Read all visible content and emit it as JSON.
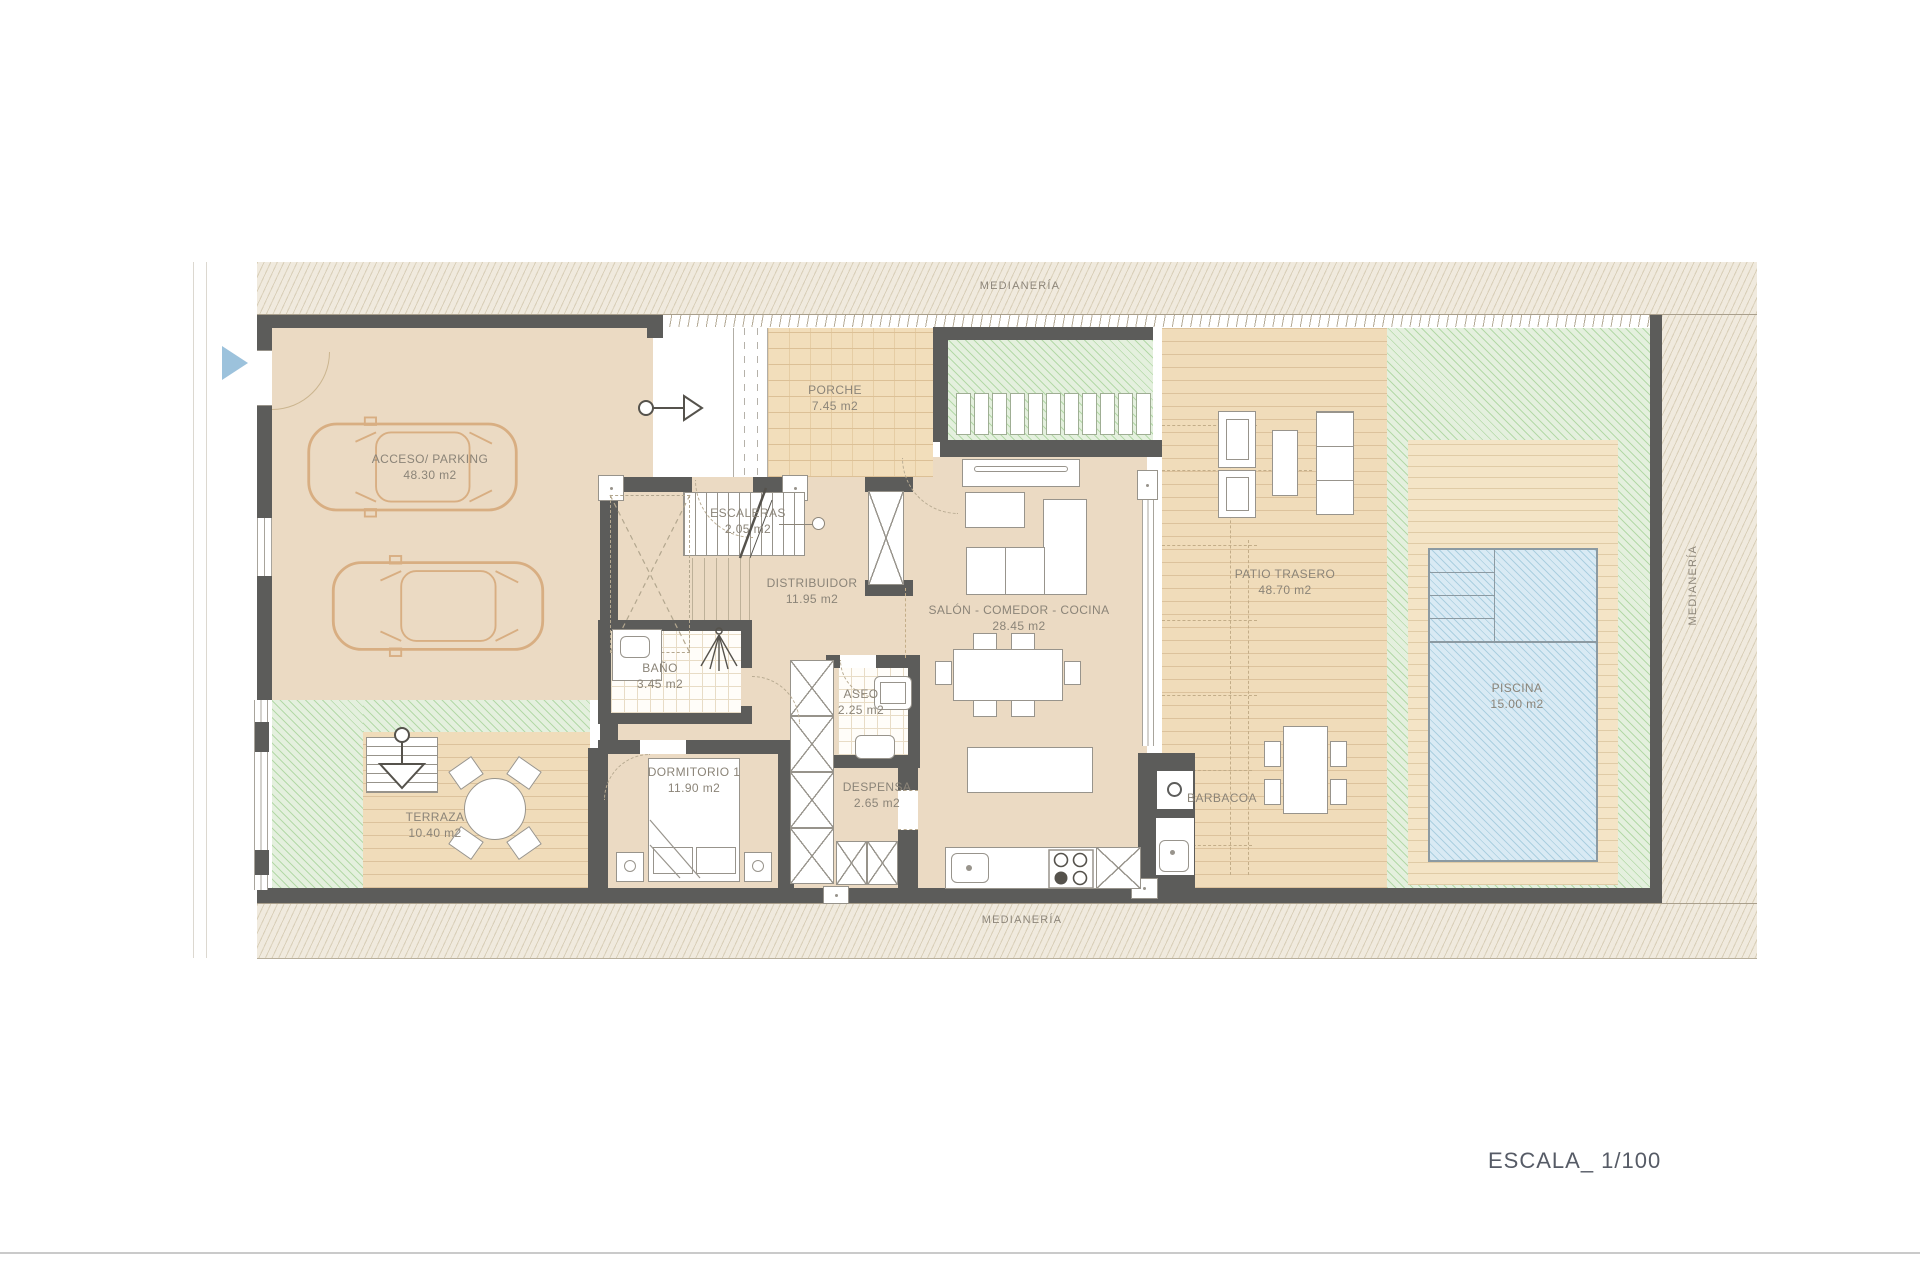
{
  "plan": {
    "scale_label": "ESCALA_ 1/100",
    "boundaries": {
      "top": "MEDIANERÍA",
      "bottom": "MEDIANERÍA",
      "right": "MEDIANERÍA"
    },
    "rooms": {
      "parking": {
        "name": "ACCESO/ PARKING",
        "area": "48.30 m2"
      },
      "porche": {
        "name": "PORCHE",
        "area": "7.45 m2"
      },
      "escaleras": {
        "name": "ESCALERAS",
        "area": "2.05 m2"
      },
      "distribuidor": {
        "name": "DISTRIBUIDOR",
        "area": "11.95 m2"
      },
      "salon": {
        "name": "SALÓN - COMEDOR - COCINA",
        "area": "28.45 m2"
      },
      "patio": {
        "name": "PATIO TRASERO",
        "area": "48.70 m2"
      },
      "bano": {
        "name": "BAÑO",
        "area": "3.45 m2"
      },
      "aseo": {
        "name": "ASEO",
        "area": "2.25 m2"
      },
      "despensa": {
        "name": "DESPENSA",
        "area": "2.65 m2"
      },
      "dormitorio": {
        "name": "DORMITORIO 1",
        "area": "11.90 m2"
      },
      "terraza": {
        "name": "TERRAZA",
        "area": "10.40 m2"
      },
      "piscina": {
        "name": "PISCINA",
        "area": "15.00 m2"
      },
      "barbacoa": {
        "name": "BARBACOA"
      }
    },
    "colors": {
      "wall": "#5c5c5a",
      "indoor_floor": "#ebdac3",
      "wood_deck": "#f0dcba",
      "green_hatch": "#e4f0de",
      "pool_water": "#d9eaf4",
      "boundary_hatch": "#f0eade",
      "label_text": "#8b8478",
      "accent_triangle": "#9cc2dc"
    }
  }
}
